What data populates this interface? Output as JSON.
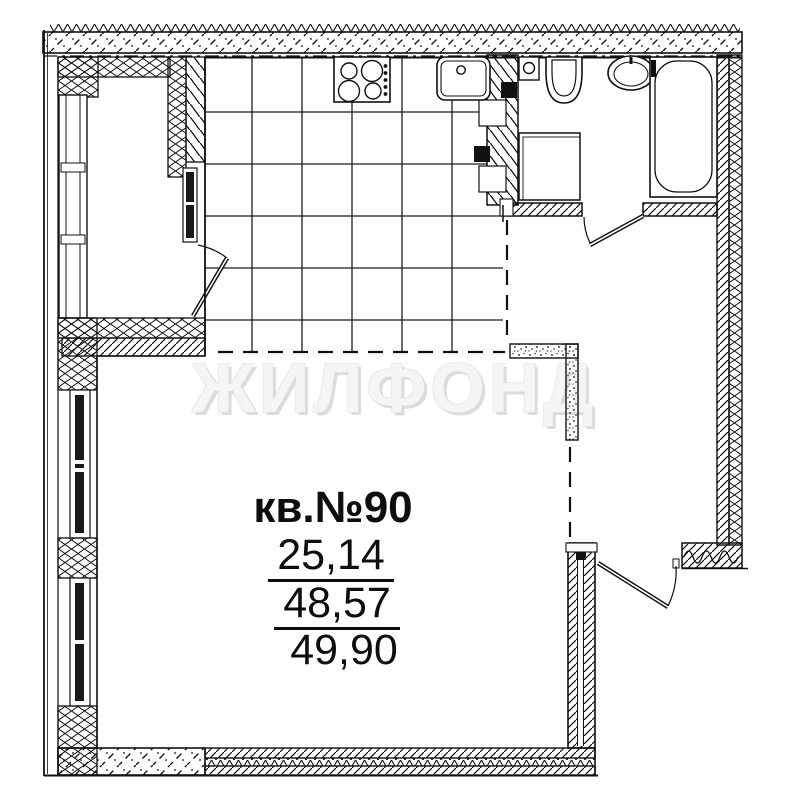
{
  "floorplan": {
    "apartment_label": "кв.№90",
    "areas": {
      "living": "25,14",
      "usable": "48,57",
      "total": "49,90"
    },
    "watermark": "ЖИЛФОНД",
    "colors": {
      "line": "#111111",
      "background": "#ffffff",
      "watermark": "#f5f5f5",
      "watermark_shadow": "#dcdcdc",
      "window_glass": "#1a1a1a"
    },
    "fixtures": [
      "stove-icon",
      "kitchen-sink-icon",
      "washing-machine-icon",
      "toilet-icon",
      "washbasin-icon",
      "bathtub-icon",
      "shower-tray-icon"
    ]
  }
}
